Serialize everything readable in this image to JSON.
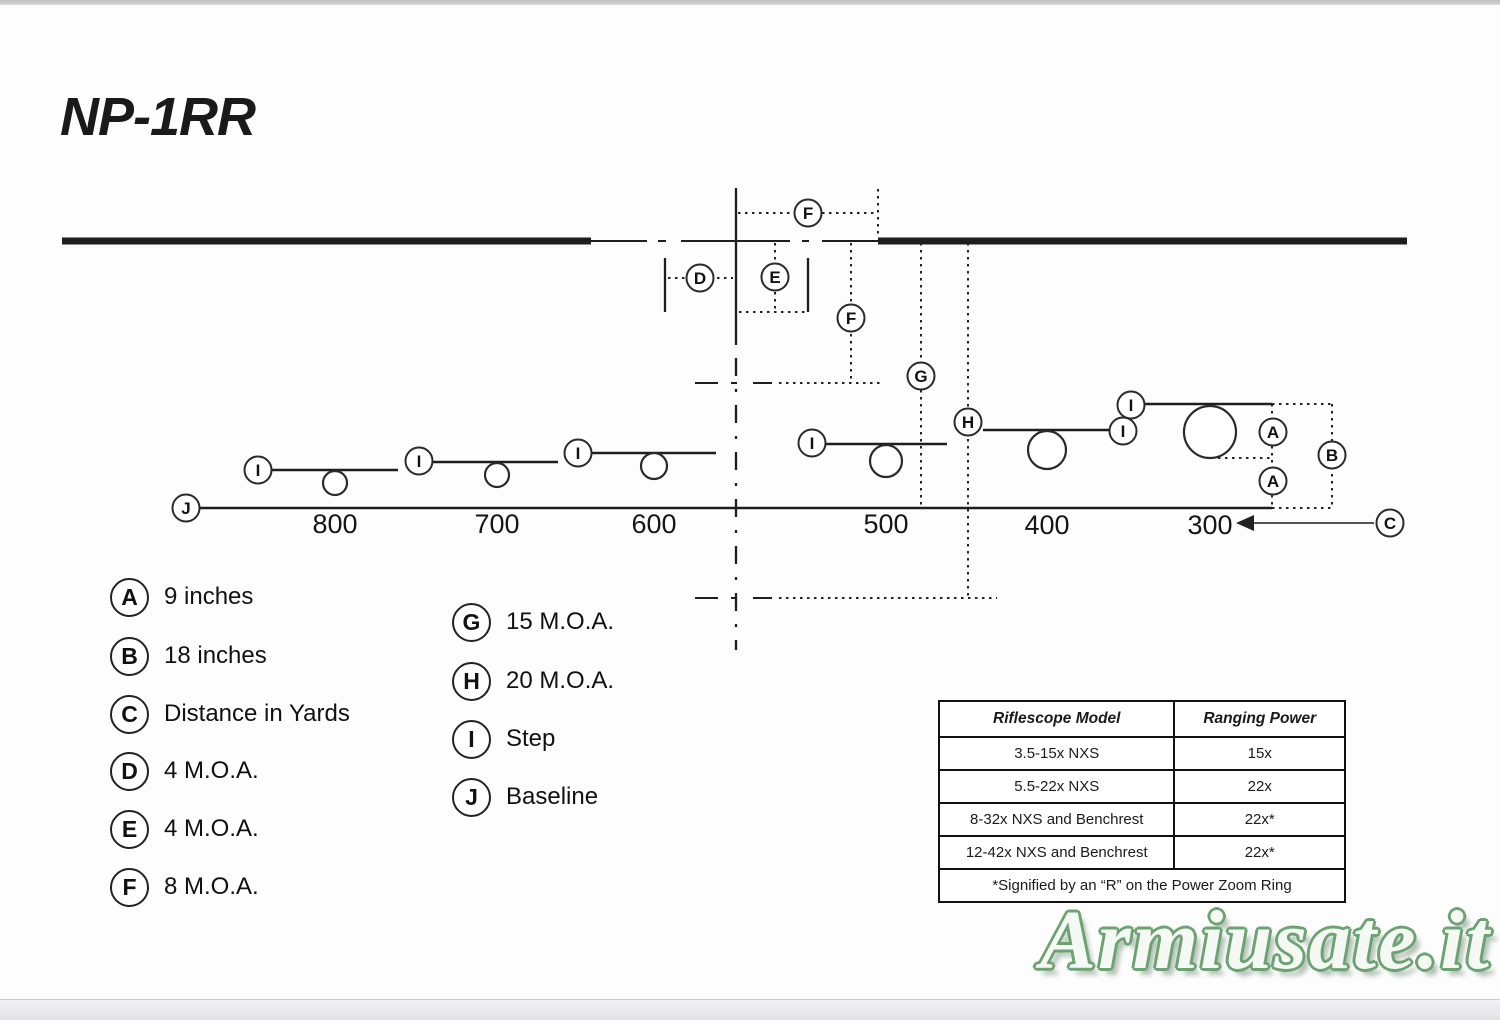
{
  "page": {
    "title": "NP-1RR",
    "page_number": "3",
    "watermark": "Armiusate.it"
  },
  "diagram": {
    "callouts": {
      "a": "A",
      "b": "B",
      "c": "C",
      "d": "D",
      "e": "E",
      "f": "F",
      "g": "G",
      "h": "H",
      "i": "I",
      "j": "J"
    },
    "distances": [
      "800",
      "700",
      "600",
      "500",
      "400",
      "300"
    ]
  },
  "legend": {
    "items": [
      {
        "letter": "A",
        "label": "9 inches"
      },
      {
        "letter": "B",
        "label": "18 inches"
      },
      {
        "letter": "C",
        "label": "Distance in Yards"
      },
      {
        "letter": "D",
        "label": "4 M.O.A."
      },
      {
        "letter": "E",
        "label": "4 M.O.A."
      },
      {
        "letter": "F",
        "label": "8 M.O.A."
      },
      {
        "letter": "G",
        "label": "15 M.O.A."
      },
      {
        "letter": "H",
        "label": "20 M.O.A."
      },
      {
        "letter": "I",
        "label": "Step"
      },
      {
        "letter": "J",
        "label": "Baseline"
      }
    ]
  },
  "table": {
    "headers": [
      "Riflescope Model",
      "Ranging Power"
    ],
    "rows": [
      [
        "3.5-15x NXS",
        "15x"
      ],
      [
        "5.5-22x NXS",
        "22x"
      ],
      [
        "8-32x NXS and Benchrest",
        "22x*"
      ],
      [
        "12-42x NXS and Benchrest",
        "22x*"
      ]
    ],
    "footnote": "*Signified by an “R” on the Power Zoom Ring"
  },
  "colors": {
    "line": "#1e1e1e",
    "watermark_green": "#6da273",
    "bottom_band": "#e0e0e6"
  }
}
